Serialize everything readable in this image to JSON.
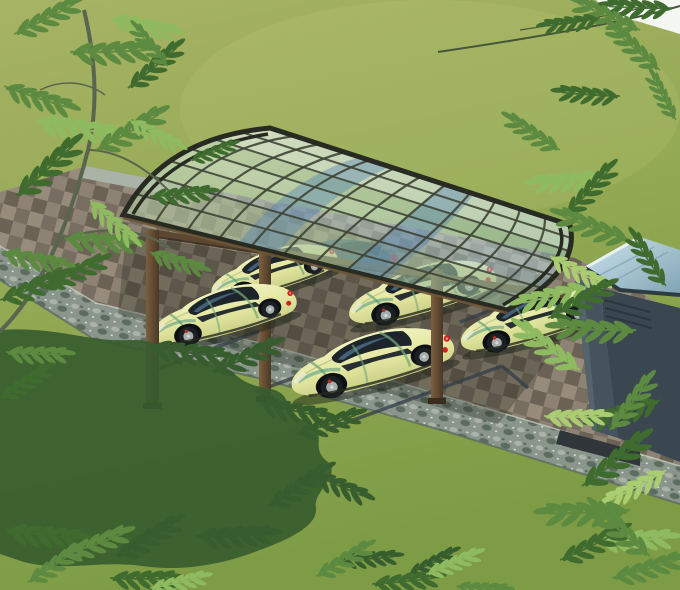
{
  "scene": {
    "type": "3d-architectural-rendering",
    "subject": "cantilever carport with curved polycarbonate roof over parked sports cars",
    "view": "aerial three-quarter view over a garden",
    "elements": {
      "carport": {
        "roof": "curved clear polycarbonate panels on dark aluminium grid frame",
        "frame_grid": "arched rafters and straight purlins",
        "posts_visible": 3,
        "beam": "bronze side beam connecting post tops"
      },
      "cars": {
        "style": "two-door sports car",
        "body_color_name": "pale yellow with green reflections",
        "visible_count": 6,
        "fully_visible": 4,
        "details": [
          "dark tinted glass",
          "red tail lights",
          "alloy wheels",
          "one car seen blue-tinted through the canopy"
        ]
      },
      "pavement": {
        "pad": "checkered paver parking pad",
        "markings": "dark parking stall lines",
        "edging": "rough grey stone border band"
      },
      "shed": "dark grey garden structure with slanted glass roof at right",
      "landscape": {
        "lawn": "green lawn covering background",
        "tree_shadow": "leafy tree shadow on lawn, lower left",
        "foliage": [
          "feather-leaf tree top left",
          "hanging branches top right",
          "ferns around shed",
          "ferns along bottom edge"
        ],
        "sky_glimpse": "small white sky patch in top-right corner"
      }
    }
  },
  "palette": {
    "lawn_light": "#a7b365",
    "lawn_mid": "#93a953",
    "lawn_dark": "#7d9c45",
    "lawn_shadow": "#375c2e",
    "sun_patch": "#c2cb7e",
    "sky_white": "#f3f6f1",
    "branch_wood": "#5a6550",
    "foliage_dark": "#3f6b2f",
    "foliage_mid": "#5c8a40",
    "foliage_light": "#8fbb60",
    "foliage_pale": "#abcd72",
    "paver_light": "#978c7b",
    "paver_mid": "#8d8273",
    "paver_dark": "#776d60",
    "paver_deep": "#6b6154",
    "stone_base": "#8a968c",
    "stone_light": "#aab3a8",
    "stone_speck": "#d8ded4",
    "stone_dark": "#5c6c61",
    "stall_line": "#333d47",
    "shadow_dark": "#1e2418",
    "canopy_glass_light": "#dfeee9",
    "canopy_glass_mid": "#b9d6cf",
    "canopy_glass_deep": "#93bac7",
    "canopy_frame": "#3f4537",
    "canopy_edge": "#272b22",
    "canopy_bronze": "#6e5637",
    "reflection_blue": "#4f7fb5",
    "post_light": "#7c5f3e",
    "post_dark": "#4a3827",
    "beam_bronze": "#5d4730",
    "car_body_light": "#f2f3c0",
    "car_body": "#e3e6a0",
    "car_body_shade": "#c9cf85",
    "car_glass": "#1e252a",
    "car_glass_refl": "#4d6f8c",
    "car_stripe": "#73a878",
    "car_stripe_teal": "#3f8f80",
    "tail_red": "#d41f1f",
    "wheel_tire": "#1b1f22",
    "wheel_rim": "#a8adad",
    "caliper_red": "#b23226",
    "ghost_car_blue": "#2b4f6e",
    "ghost_glass": "#16304a",
    "ornament_red": "#cc2020",
    "shed_glass_light": "#cfe4ec",
    "shed_glass_deep": "#7fa4b4",
    "shed_wall": "#3a4650",
    "shed_wall_light": "#46535e",
    "shed_base": "#31363a"
  }
}
